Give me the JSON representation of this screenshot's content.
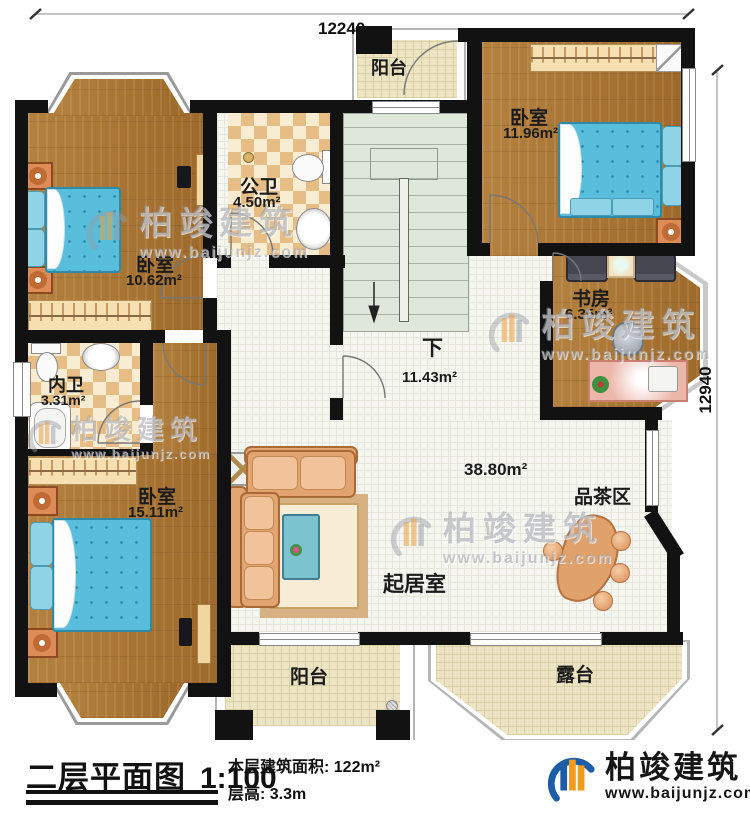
{
  "dimensions": {
    "top": "12240",
    "right": "12940"
  },
  "rooms": {
    "balcony_top": {
      "label": "阳台"
    },
    "bedroom_top_right": {
      "label": "卧室",
      "area": "11.96m²"
    },
    "public_bathroom": {
      "label": "公卫",
      "area": "4.50m²"
    },
    "bedroom_top_left": {
      "label": "卧室",
      "area": "10.62m²"
    },
    "study": {
      "label": "书房",
      "area": "6.35m²"
    },
    "inner_bathroom": {
      "label": "内卫",
      "area": "3.31m²"
    },
    "bedroom_bottom_left": {
      "label": "卧室",
      "area": "15.11m²"
    },
    "stairs": {
      "label": "下",
      "area": "11.43m²"
    },
    "living_room": {
      "label": "起居室",
      "area": "38.80m²"
    },
    "tea_area": {
      "label": "品茶区"
    },
    "balcony_bottom": {
      "label": "阳台"
    },
    "terrace": {
      "label": "露台"
    }
  },
  "footer": {
    "title": "二层平面图",
    "scale": "1:100",
    "floor_area_label": "本层建筑面积: ",
    "floor_area_value": "122m²",
    "floor_height_label": "层高: ",
    "floor_height_value": "3.3m",
    "brand": "柏竣建筑",
    "website": "www.baijunjz.com"
  },
  "watermark": {
    "brand": "柏竣建筑",
    "website": "www.baijunjz.com"
  },
  "colors": {
    "wall": "#121212",
    "wood_floor": "#ad7836",
    "bed_blue": "#58bedb",
    "bath_tile": "#e6bd85",
    "stair_green": "#dfe6da",
    "balcony_tile": "#ece4c3",
    "brand_blue": "#1d5da8",
    "brand_orange": "#f29b1d"
  }
}
